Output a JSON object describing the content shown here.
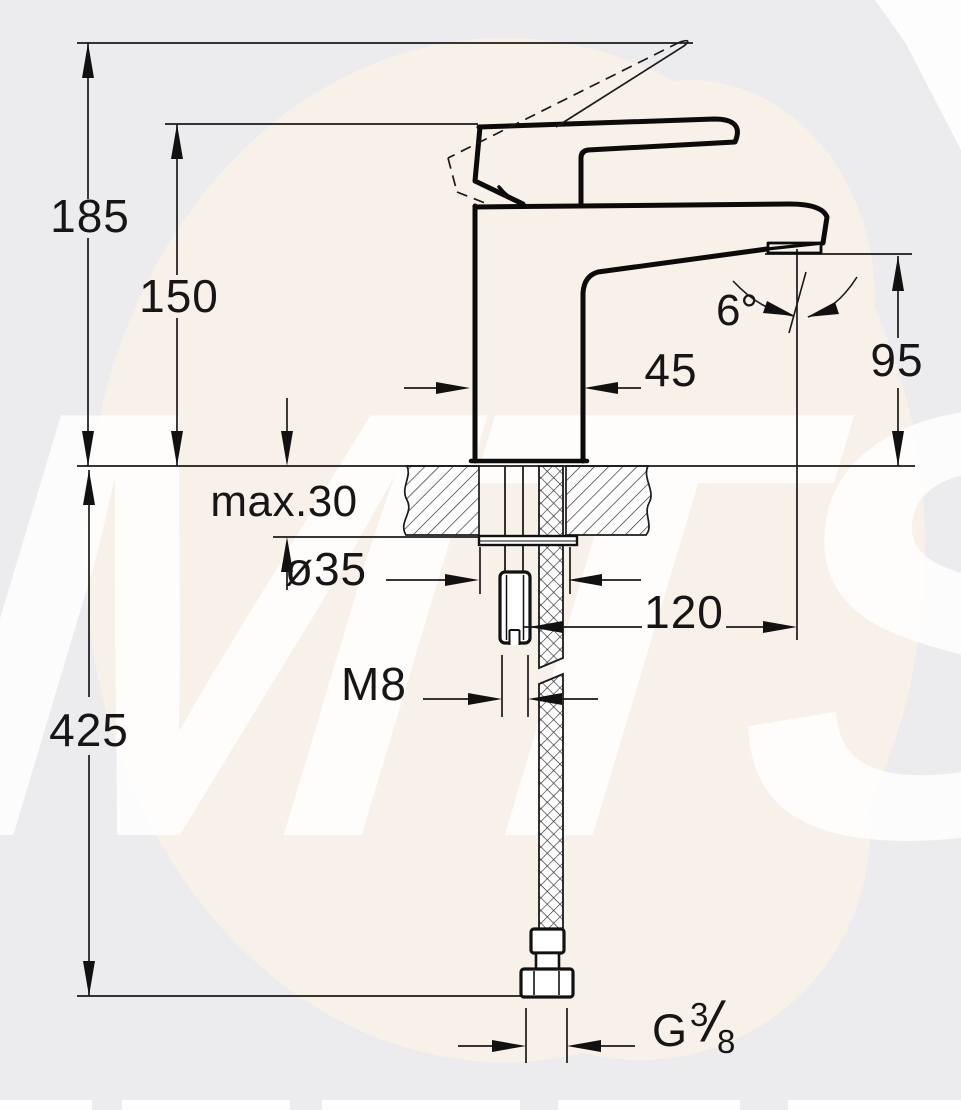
{
  "watermark": {
    "text": "MTS"
  },
  "drawing": {
    "type": "technical-dimension-drawing",
    "subject": "single-lever basin mixer tap, side view with deck mounting cross-section",
    "dimensions": {
      "overall_height": "185",
      "height_to_handle_top": "150",
      "spout_angle": "6°",
      "spout_outlet_height": "95",
      "body_width": "45",
      "max_deck_thickness": "max.30",
      "tap_hole_diameter": "ø35",
      "spout_projection": "120",
      "fixing_stud_thread": "M8",
      "hose_length": "425",
      "hose_connection": {
        "prefix": "G",
        "numerator": "3",
        "slash": "/",
        "denominator": "8"
      }
    }
  }
}
